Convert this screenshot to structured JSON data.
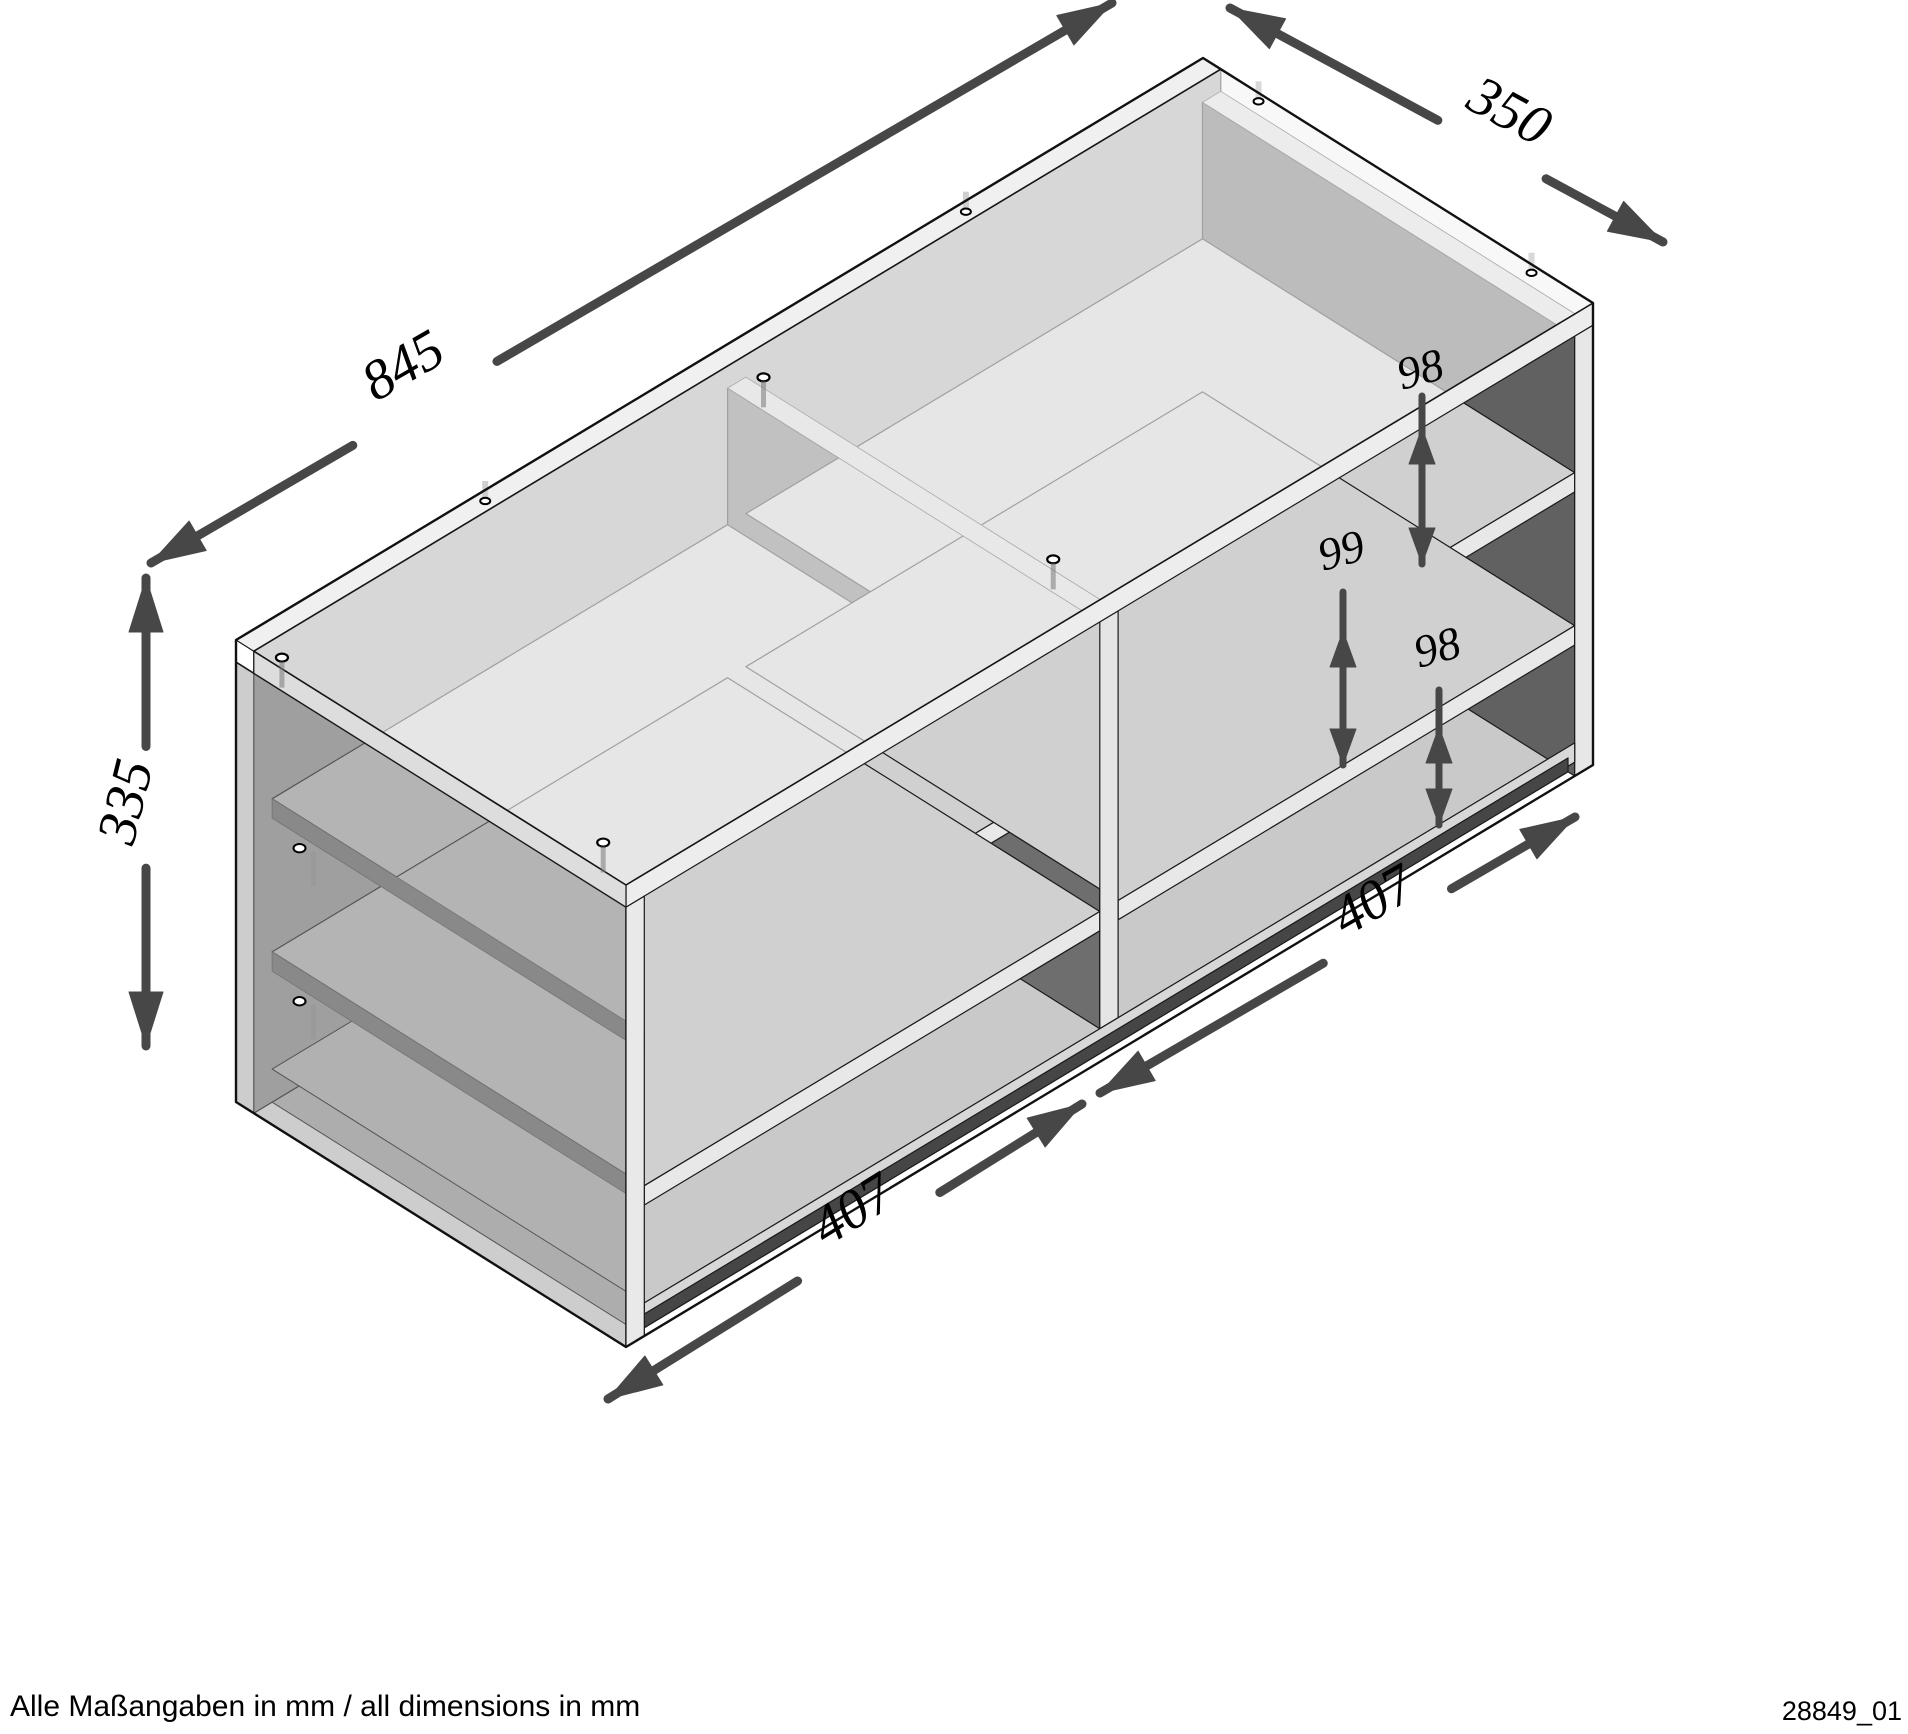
{
  "diagram": {
    "type": "furniture-dimension-drawing",
    "object": "shelf sideboard with center divider, two compartments, two shelves per compartment",
    "units": "mm",
    "dims": {
      "width": {
        "value": "845"
      },
      "depth": {
        "value": "350"
      },
      "height": {
        "value": "335"
      },
      "left_compartment": {
        "value": "407"
      },
      "right_compartment": {
        "value": "407"
      },
      "gap_top": {
        "value": "98"
      },
      "gap_middle": {
        "value": "99"
      },
      "gap_bottom": {
        "value": "98"
      }
    },
    "footer": {
      "note": "Alle Maßangaben in mm / all dimensions in mm",
      "drawing_number": "28849_01"
    },
    "colors": {
      "outline": "#1a1a1a",
      "dimension": "#474747",
      "top_face": "#f4f4f4",
      "back_face": "#a8a8a8",
      "divider_shadow": "#6e6e6e",
      "right_inner_shadow": "#616161",
      "plinth": "#464646"
    }
  }
}
